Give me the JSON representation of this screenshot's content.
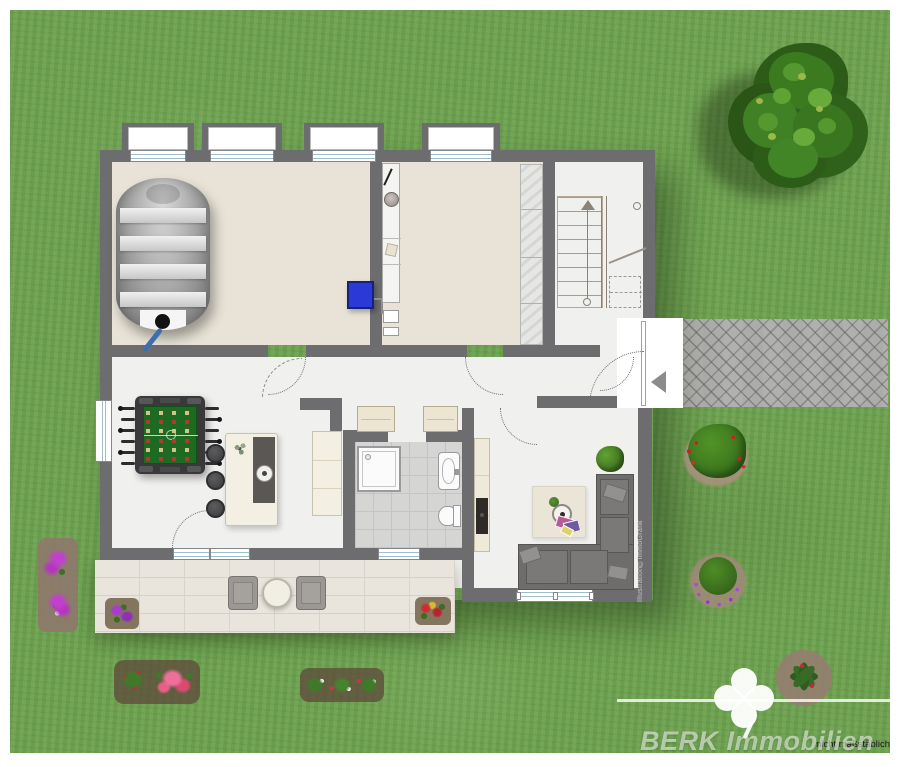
{
  "branding": {
    "watermark_text": "BERK Immobilien",
    "watermark_logo": "four-leaf-clover-icon",
    "disclaimer_text": "nicht maßstäblich",
    "credit_text": "Illustration©ImmoGrafik"
  },
  "palette": {
    "lawn_green": "#6FA351",
    "wall_gray": "#6D6D6F",
    "floor_beige": "#E8E3D6",
    "floor_light": "#F0F0EE",
    "tile_gray": "#D5D5D3",
    "patio_stone": "#E9E5DD",
    "path_gray": "#ACACAA",
    "accent_blue": "#2B3AD4",
    "sofa_gray": "#6F6C6C",
    "foosball_green": "#1E6A22"
  },
  "floorplan": {
    "rooms": [
      {
        "name": "tank-room",
        "floor": "beige",
        "objects": [
          "storage-tank",
          "wall-mounted-blue-unit"
        ]
      },
      {
        "name": "utility-room",
        "floor": "beige",
        "objects": [
          "boiler-column",
          "shelf-column",
          "stone-cupboard"
        ]
      },
      {
        "name": "stair-hall",
        "floor": "light",
        "objects": [
          "staircase",
          "entrance-door",
          "entrance-arrow"
        ]
      },
      {
        "name": "hobby-room",
        "floor": "light",
        "objects": [
          "foosball-table",
          "bar-counter",
          "bar-stools",
          "sideboard"
        ]
      },
      {
        "name": "bathroom",
        "floor": "tiles",
        "objects": [
          "shower",
          "washbasin",
          "toilet",
          "wardrobes"
        ]
      },
      {
        "name": "living-room",
        "floor": "light",
        "objects": [
          "corner-sofa",
          "rug",
          "coffee-table",
          "tv-sideboard",
          "potted-plant"
        ]
      }
    ],
    "window_count": 8,
    "entrance": {
      "marker": "arrow-left",
      "path_style": "herringbone-paving"
    }
  },
  "garden": {
    "elements": [
      "tree",
      "shrub-red-flowers",
      "shrub-purple-flowers",
      "flower-bed-left",
      "flower-bed-bottom-left",
      "flower-bed-bottom-center",
      "flower-bed-bottom-right",
      "patio",
      "patio-table",
      "patio-chairs",
      "patio-flowers-purple",
      "patio-flowers-red"
    ]
  }
}
